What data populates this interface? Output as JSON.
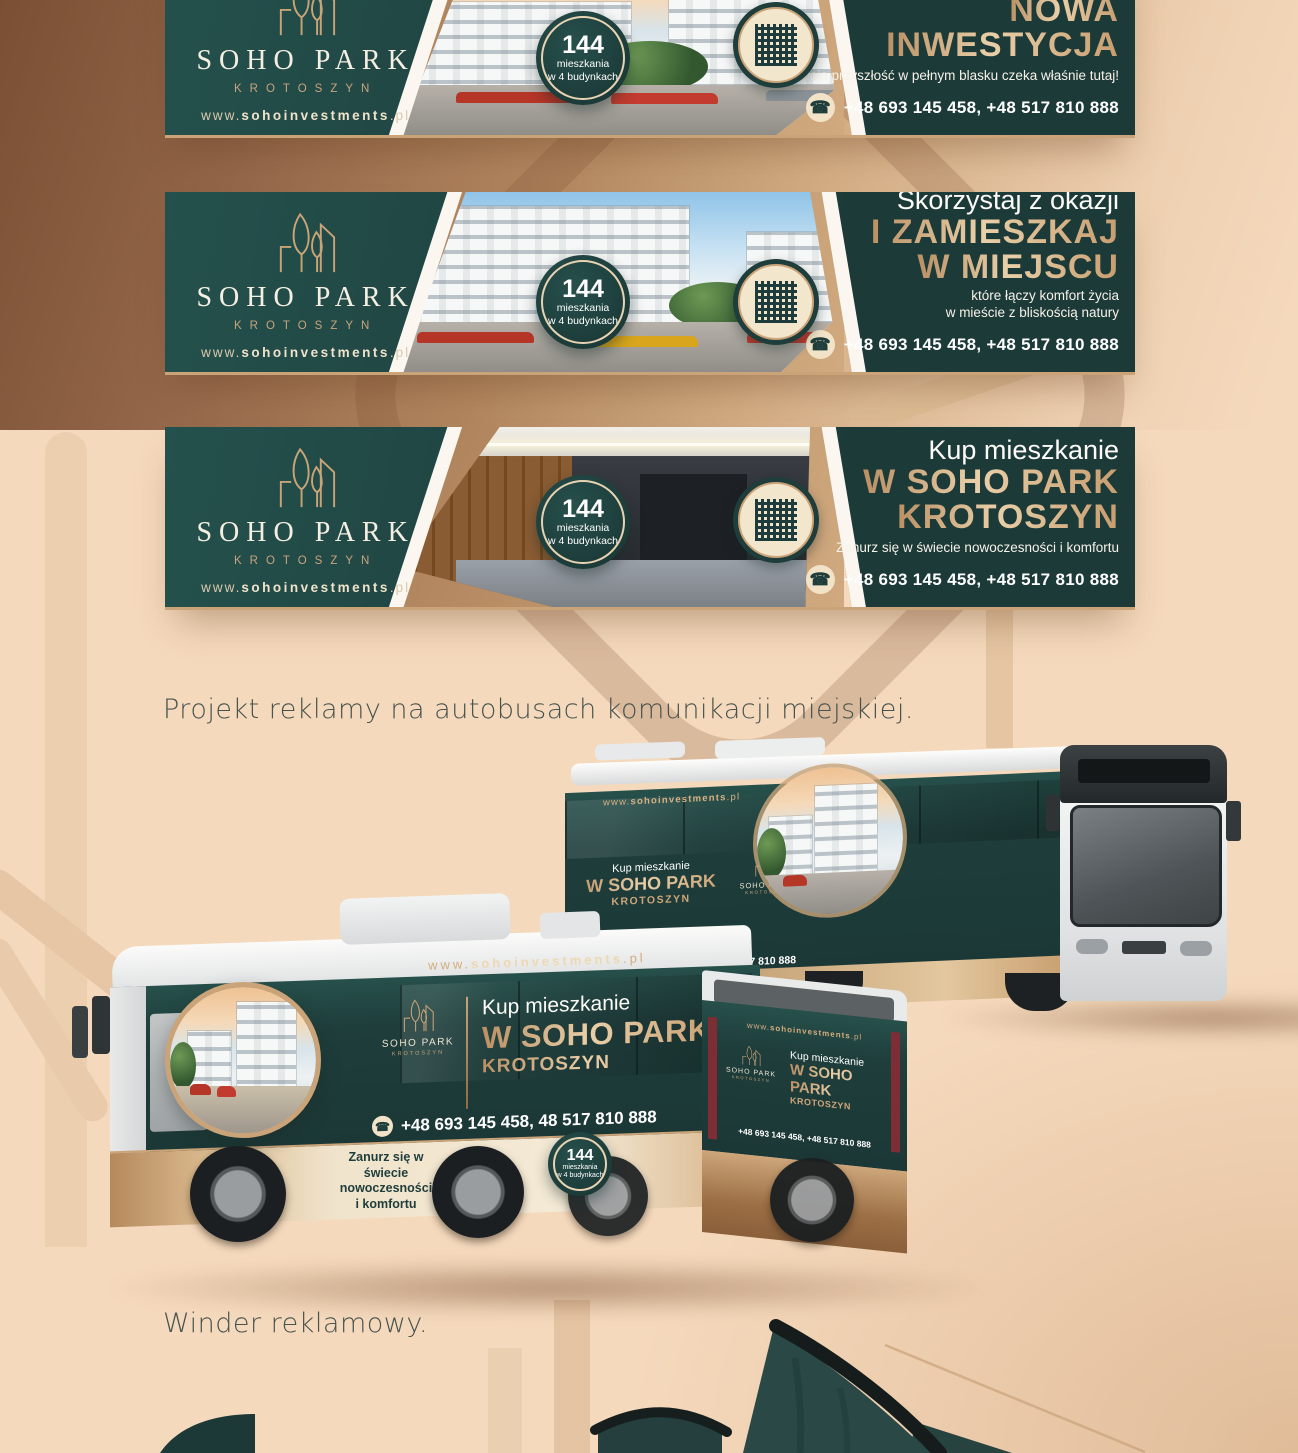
{
  "colors": {
    "teal": "#1e3d3b",
    "gold": "#cda57a",
    "peach": "#f5d9bc",
    "brown": "#8a5c3e",
    "cream": "#f0e2ca",
    "flag": "#2a4846"
  },
  "icons": {
    "phone": "☎"
  },
  "logo": {
    "name": "SOHO PARK",
    "city": "KROTOSZYN",
    "url_pre": "www.",
    "url_bold": "sohoinvestments",
    "url_post": ".pl"
  },
  "badge": {
    "number": "144",
    "line1": "mieszkania",
    "line2": "w 4 budynkach"
  },
  "contact": {
    "phones": "+48 693 145 458, +48 517 810 888",
    "phones_bus_side": "+48 693 145 458, 48 517 810 888"
  },
  "banners": [
    {
      "intro": "Tu powstaje",
      "main1": "NOWA",
      "main2": "INWESTYCJA",
      "sub1": "Twoja przyszłość w pełnym blasku czeka właśnie tutaj!"
    },
    {
      "intro": "Skorzystaj z okazji",
      "main1": "I ZAMIESZKAJ",
      "main2": "W MIEJSCU",
      "sub1": "które łączy komfort życia",
      "sub2": "w mieście z bliskością natury"
    },
    {
      "intro": "Kup mieszkanie",
      "main1": "W SOHO PARK",
      "main2": "KROTOSZYN",
      "sub1": "Zanurz się w świecie nowoczesności i komfortu"
    }
  ],
  "sections": {
    "buses_heading": "Projekt reklamy na autobusach komunikacji miejskiej.",
    "winder_heading": "Winder reklamowy."
  },
  "bus_ad": {
    "intro": "Kup mieszkanie",
    "main": "W SOHO PARK",
    "city": "KROTOSZYN",
    "tagline1": "Zanurz się w świecie",
    "tagline2": "nowoczesności",
    "tagline3": "i komfortu"
  }
}
